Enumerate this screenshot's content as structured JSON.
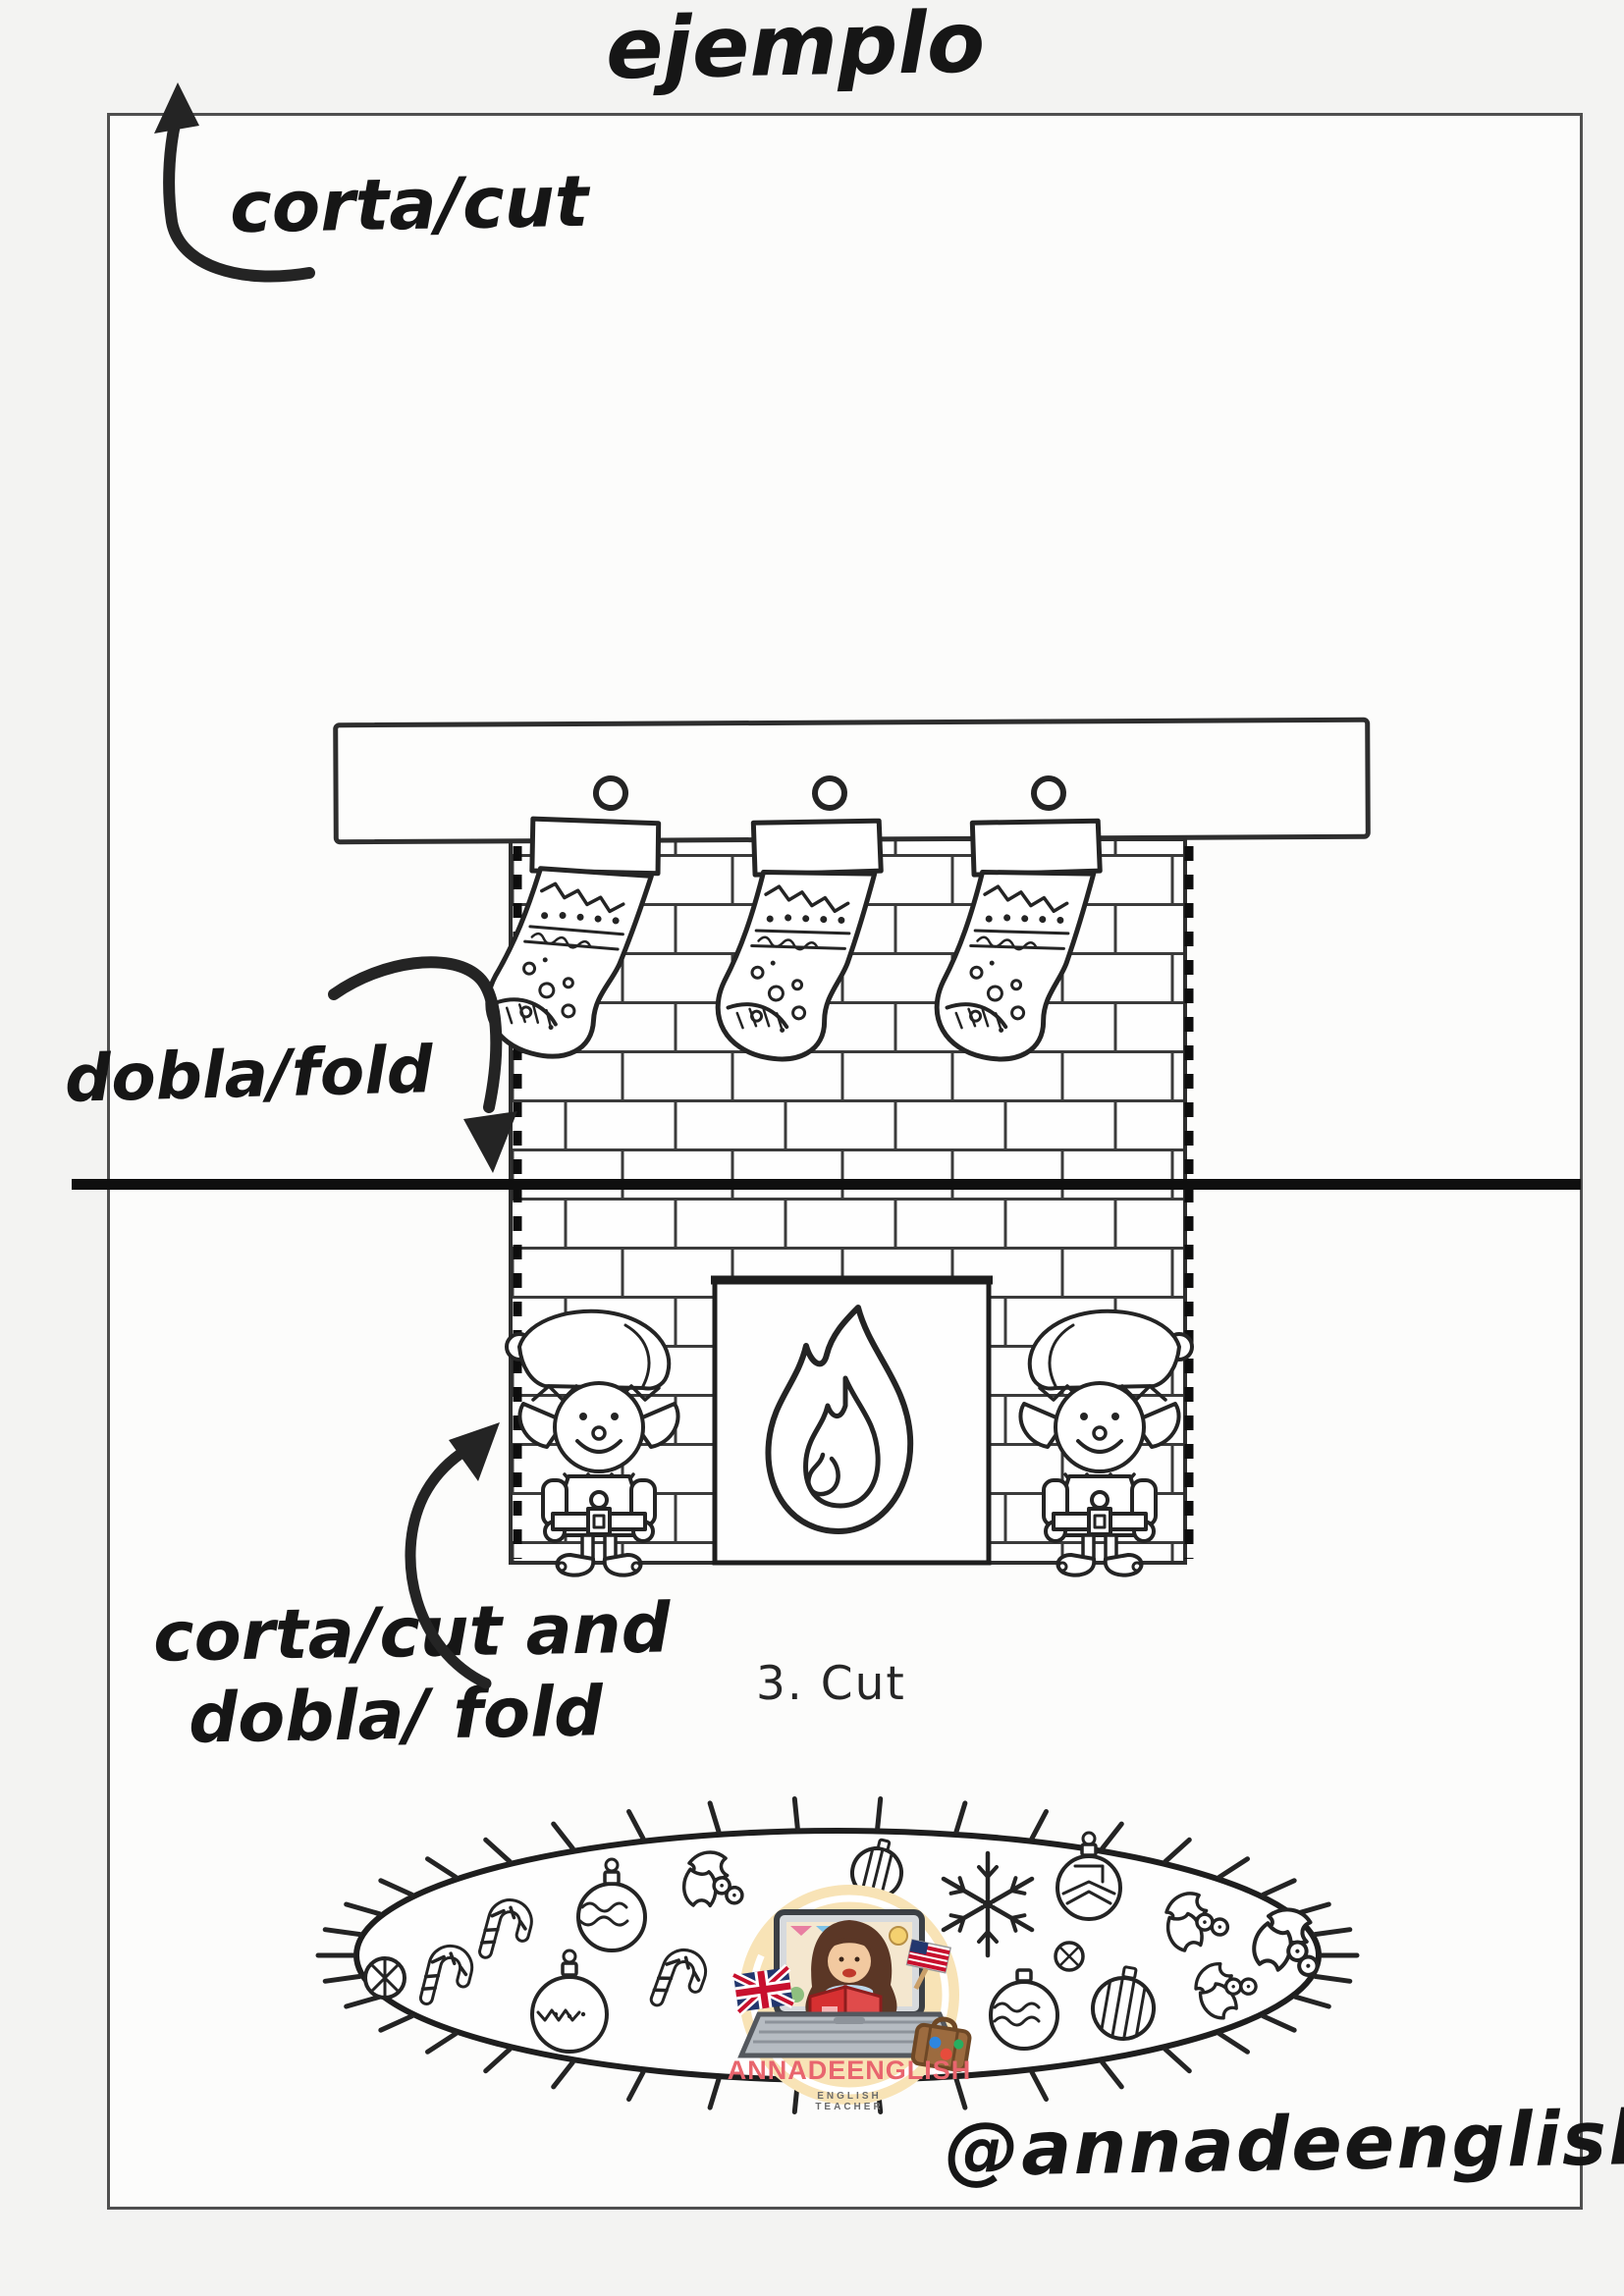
{
  "page": {
    "title": "ejemplo",
    "handle": "@annadeenglish",
    "step_label": "3. Cut"
  },
  "labels": {
    "cut": "corta/cut",
    "fold": "dobla/fold",
    "cut_and_fold_line1": "corta/cut and",
    "cut_and_fold_line2": "dobla/ fold"
  },
  "logo": {
    "brand": "ANNADEENGLISH",
    "tagline": "ENGLISH TEACHER"
  },
  "colors": {
    "ink": "#1b1b1b",
    "page_border": "#4f4f4f",
    "fold_line": "#0f0f0f",
    "logo_background": "#f8e3b6",
    "brand_text": "#e8656e",
    "tagline_text": "#6b6b6b",
    "book_red": "#d63031",
    "flag_navy": "#23376e",
    "flag_red": "#c8102e",
    "laptop_grey": "#b6bcc2",
    "suitcase_brown": "#9c6b3f"
  },
  "illustration": {
    "fireplace": {
      "stocking_count": 3,
      "elf_count": 2,
      "parts": [
        "mantel",
        "brick-chimney",
        "dotted-cut-lines",
        "firebox",
        "flame",
        "stockings",
        "elves"
      ]
    },
    "rug": {
      "items": [
        "candy-cane",
        "bauble",
        "holly",
        "snowflake",
        "ball"
      ]
    }
  }
}
